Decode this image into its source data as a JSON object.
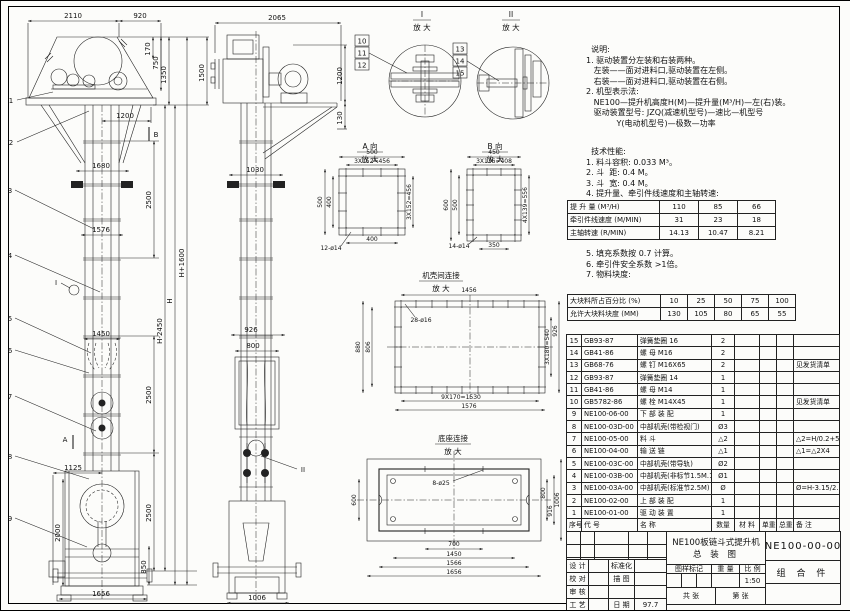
{
  "sheet_title": "NE100板链斗式提升机总装图",
  "notes": {
    "lines": [
      "  说明:",
      "1. 驱动装置分左装和右装两种。",
      "   左装——面对进料口,驱动装置在左侧。",
      "   右装——面对进料口,驱动装置在右侧。",
      "2. 机型表示法:",
      "   NE100—提升机高度H(M)—提升量(M³/H)—左(右)装。",
      "   驱动装置型号: JZQ(减速机型号)—速比—机型号",
      "            Y(电动机型号)—极数—功率"
    ],
    "tech1": [
      "  技术性能:",
      "1. 料斗容积: 0.033 M³。",
      "2. 斗  距: 0.4 M。",
      "3. 斗  宽: 0.4 M。",
      "4. 提升量、牵引件线速度和主轴转速:"
    ],
    "tech2": [
      "5. 填充系数按 0.7 计算。",
      "6. 牵引件安全系数 >1倍。",
      "7. 物料块度:"
    ]
  },
  "chart_data": [
    {
      "type": "table",
      "title": "提升量、牵引件线速度和主轴转速",
      "rows": [
        [
          "提 升 量 (M³/H)",
          "110",
          "85",
          "66"
        ],
        [
          "牵引件线速度 (M/MIN)",
          "31",
          "23",
          "18"
        ],
        [
          "主轴转速 (R/MIN)",
          "14.13",
          "10.47",
          "8.21"
        ]
      ]
    },
    {
      "type": "table",
      "title": "物料块度",
      "rows": [
        [
          "大块料所占百分比 (%)",
          "10",
          "25",
          "50",
          "75",
          "100"
        ],
        [
          "允许大块料块度 (MM)",
          "130",
          "105",
          "80",
          "65",
          "55"
        ]
      ]
    }
  ],
  "perf": {
    "rows": [
      [
        "提 升 量 (M³/H)",
        "110",
        "85",
        "66"
      ],
      [
        "牵引件线速度 (M/MIN)",
        "31",
        "23",
        "18"
      ],
      [
        "主轴转速 (R/MIN)",
        "14.13",
        "10.47",
        "8.21"
      ]
    ]
  },
  "lump": {
    "rows": [
      [
        "大块料所占百分比 (%)",
        "10",
        "25",
        "50",
        "75",
        "100"
      ],
      [
        "允许大块料块度 (MM)",
        "130",
        "105",
        "80",
        "65",
        "55"
      ]
    ]
  },
  "parts": {
    "rows": [
      [
        "15",
        "GB93-87",
        "弹簧垫圈 16",
        "2",
        "",
        "",
        "",
        ""
      ],
      [
        "14",
        "GB41-86",
        "螺 母 M16",
        "2",
        "",
        "",
        "",
        ""
      ],
      [
        "13",
        "GB68-76",
        "螺 钉 M16X65",
        "2",
        "",
        "",
        "",
        "见发货清单"
      ],
      [
        "12",
        "GB93-87",
        "弹簧垫圈 14",
        "1",
        "",
        "",
        "",
        ""
      ],
      [
        "11",
        "GB41-86",
        "螺 母 M14",
        "1",
        "",
        "",
        "",
        ""
      ],
      [
        "10",
        "GB5782-86",
        "螺 栓 M14X45",
        "1",
        "",
        "",
        "",
        "见发货清单"
      ],
      [
        "9",
        "NE100-06-00",
        "下 部 装 配",
        "1",
        "",
        "",
        "",
        ""
      ],
      [
        "8",
        "NE100-03D-00",
        "中部机壳(带检视门)",
        "Ø3",
        "",
        "",
        "",
        ""
      ],
      [
        "7",
        "NE100-05-00",
        "料 斗",
        "△2",
        "",
        "",
        "",
        "△2=H/0.2+5.75"
      ],
      [
        "6",
        "NE100-04-00",
        "输 送 链",
        "△1",
        "",
        "",
        "",
        "△1=△2X4"
      ],
      [
        "5",
        "NE100-03C-00",
        "中部机壳(带导轨)",
        "Ø2",
        "",
        "",
        "",
        ""
      ],
      [
        "4",
        "NE100-03B-00",
        "中部机壳(非标节1.5M.1M)",
        "Ø1",
        "",
        "",
        "",
        ""
      ],
      [
        "3",
        "NE100-03A-00",
        "中部机壳(标准节2.5M)",
        "Ø",
        "",
        "",
        "",
        "Ø=H-3.15/2.5"
      ],
      [
        "2",
        "NE100-02-00",
        "上 部 装 配",
        "1",
        "",
        "",
        "",
        ""
      ],
      [
        "1",
        "NE100-01-00",
        "驱 动 装 置",
        "1",
        "",
        "",
        "",
        ""
      ]
    ],
    "header_rows": [
      [
        "序号",
        "代  号",
        "名  称",
        "数量",
        "材 料",
        "单重",
        "总重",
        "备 注"
      ]
    ]
  },
  "titleblock": {
    "product": "NE100板链斗式提升机",
    "drawing_title": "总  装  图",
    "drawing_no": "NE100-00-00",
    "part_type": "组 合 件",
    "scale_value": "1:50",
    "rev_rows": [
      [
        "",
        "",
        "",
        "",
        ""
      ],
      [
        "",
        "",
        "",
        "",
        ""
      ],
      [
        "",
        "",
        "",
        "",
        ""
      ],
      [
        "标记",
        "处数",
        "更改文件号",
        "签 字",
        "日 期"
      ]
    ],
    "sig_rows": [
      [
        "设 计",
        "",
        "标准化",
        ""
      ],
      [
        "校 对",
        "",
        "描 图",
        ""
      ],
      [
        "审 核",
        "",
        "",
        ""
      ],
      [
        "工 艺",
        "",
        "日 期",
        "97.7"
      ]
    ],
    "hdr_mark": "图样标记",
    "hdr_weight": "重 量",
    "hdr_scale": "比 例",
    "sheets_total": "共    张",
    "sheet_no": "第    张"
  },
  "views": {
    "front": {
      "leaders": [
        "1",
        "2",
        "3",
        "4",
        "5",
        "6",
        "7",
        "8",
        "9"
      ],
      "dims": [
        "2110",
        "920",
        "1200",
        "170",
        "750",
        "1350",
        "1500",
        "1680",
        "1576",
        "1450",
        "1125",
        "2000",
        "850",
        "1656",
        "2500",
        "2500",
        "2500",
        "H-2450",
        "H",
        "H+1600"
      ],
      "marks": {
        "a": "A",
        "b": "B",
        "i": "I"
      }
    },
    "side": {
      "leaders": [
        "10",
        "11",
        "12"
      ],
      "dims": [
        "2065",
        "1200",
        "130",
        "1030",
        "926",
        "800",
        "1006"
      ],
      "mark": "II"
    }
  },
  "details": {
    "i": {
      "label": "I",
      "mag": "放 大"
    },
    "ii": {
      "label": "II",
      "mag": "放 大",
      "leaders": [
        "13",
        "14",
        "15"
      ]
    },
    "va": {
      "title": "A 向",
      "mag": "放 大",
      "dims": [
        "500",
        "3X152=456",
        "500",
        "400",
        "3X152=456",
        "400",
        "12-ø14"
      ]
    },
    "vb": {
      "title": "B 向",
      "mag": "放 大",
      "dims": [
        "450",
        "3X136=408",
        "600",
        "500",
        "4X139=556",
        "350",
        "14-ø14"
      ]
    },
    "casing": {
      "title": "机壳间连接",
      "mag": "放 大",
      "dims": [
        "1456",
        "28-ø16",
        "880",
        "806",
        "3X180=540",
        "926",
        "9X170=1530",
        "1576"
      ]
    },
    "base": {
      "title": "底座连接",
      "mag": "放 大",
      "dims": [
        "8-ø25",
        "600",
        "800",
        "916",
        "1006",
        "700",
        "1450",
        "1566",
        "1656"
      ]
    }
  }
}
